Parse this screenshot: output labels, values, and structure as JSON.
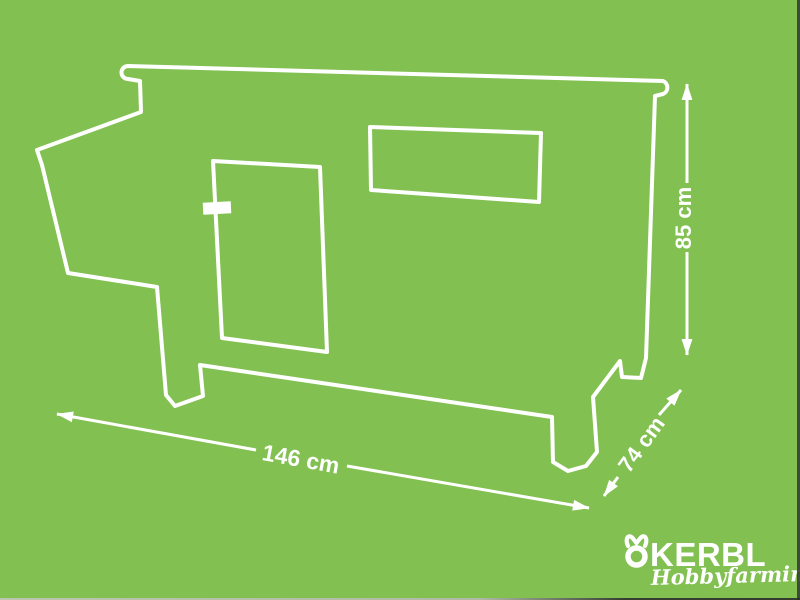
{
  "colors": {
    "background": "#82c151",
    "line": "#ffffff",
    "logo": "#ffffff"
  },
  "dimensions": {
    "width": {
      "label": "146 cm"
    },
    "depth": {
      "label": "74 cm"
    },
    "height": {
      "label": "85 cm"
    }
  },
  "brand": {
    "name": "KERBL",
    "tagline": "Hobbyfarming"
  }
}
